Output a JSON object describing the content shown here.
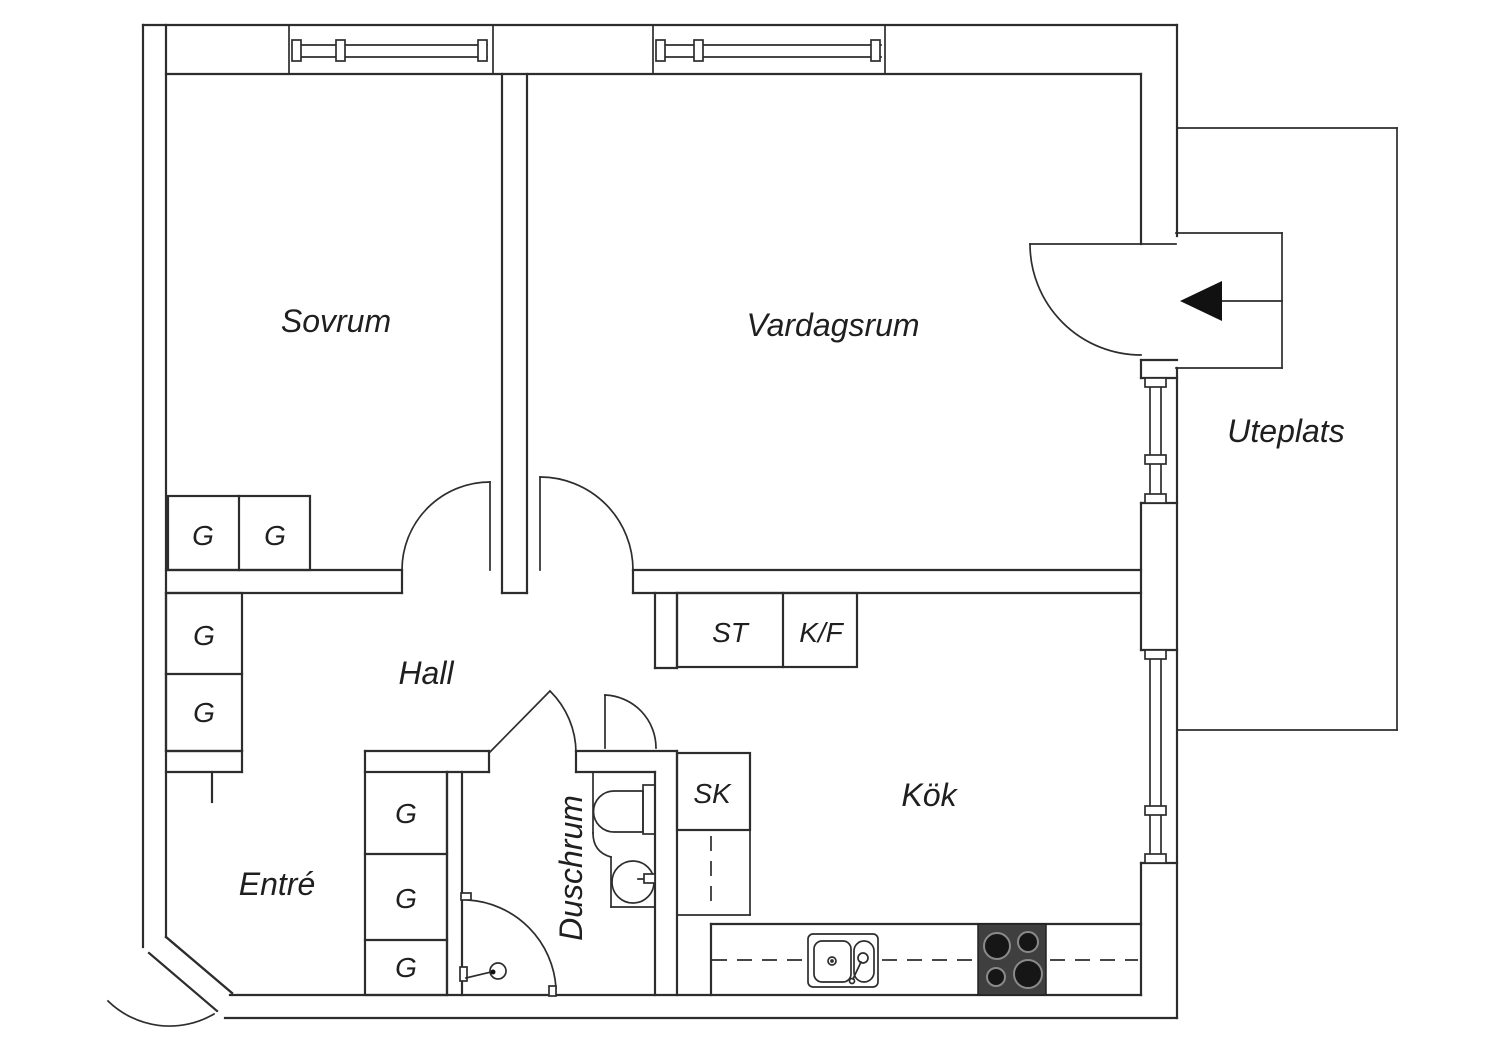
{
  "plan": {
    "rooms": {
      "sovrum": "Sovrum",
      "vardagsrum": "Vardagsrum",
      "uteplats": "Uteplats",
      "hall": "Hall",
      "entre": "Entré",
      "duschrum": "Duschrum",
      "kok": "Kök"
    },
    "storage": {
      "wardrobe": "G",
      "st": "ST",
      "kf": "K/F",
      "sk": "SK"
    },
    "colors": {
      "line": "#2d2d2d",
      "background": "#ffffff",
      "stove": "#3f3f3f",
      "arrow": "#111111"
    }
  }
}
